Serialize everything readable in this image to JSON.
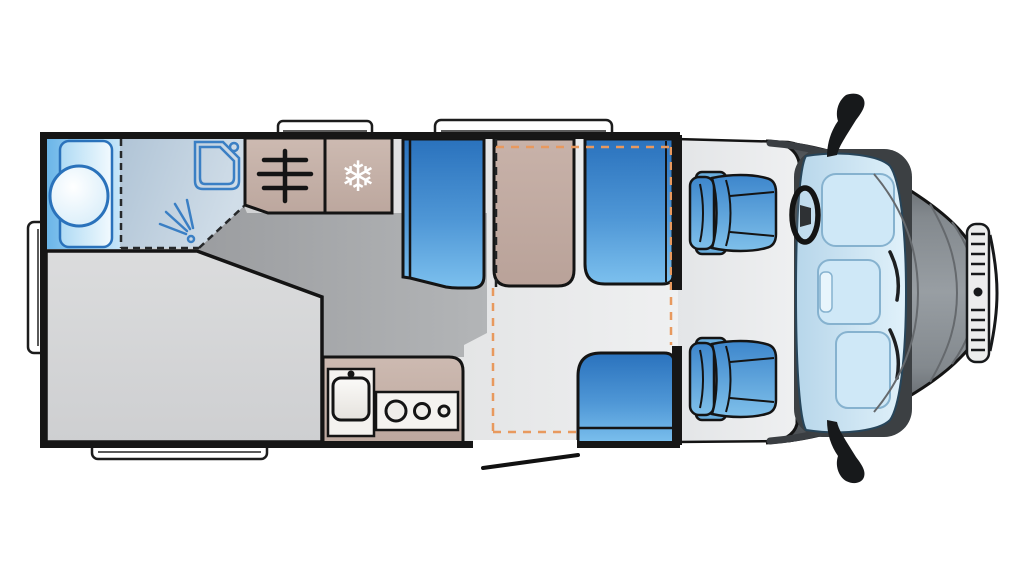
{
  "meta": {
    "title": "Motorhome floor plan, top view",
    "type": "vehicle-floorplan",
    "text_visible": false
  },
  "icons": {
    "snowflake_glyph": "❄",
    "names": [
      "roof-vent-icon",
      "side-hatch-icon",
      "wardrobe-rail-icon",
      "fridge-snowflake-icon",
      "shower-tray-icon",
      "shower-spray-icon",
      "washbasin-icon",
      "sink-icon",
      "hob-burners-icon",
      "steering-wheel-icon",
      "wing-mirror-icon",
      "grille-icon",
      "entrance-door-swing-icon",
      "drop-down-bed-outline"
    ]
  },
  "palette": {
    "background": "#ffffff",
    "wall": "#161616",
    "outline": "#141414",
    "furniture_beige": "#c6b2a9",
    "table_beige": "#bfa89f",
    "seat_blue_dark": "#2a72bd",
    "seat_blue_light": "#7cc0ee",
    "cab_seat_blue": "#3d86cc",
    "bathroom_blue": "#a8d8f4",
    "shower_gray_blue": "#bccfdd",
    "fixture_blue_line": "#3a7fc4",
    "floor_light": "#e9eaeb",
    "floor_mid": "#bfc1c3",
    "floor_dark": "#a5a7a9",
    "bed_gray": "#d6d7d9",
    "cab_body_gray": "#8f959a",
    "cab_body_shadow": "#3f4347",
    "windscreen_blue": "#cfe4f2",
    "dashed_bed_orange": "#e8995e",
    "dashed_partition_black": "#26282a"
  },
  "areas": {
    "bathroom": "rear washroom with basin, vanity and fold-away shower",
    "wardrobe": "wardrobe with clothes rail",
    "fridge": "refrigerator",
    "rear_bed": "rear french bed",
    "kitchen": "kitchen block with sink and 3-burner hob",
    "dinette": "dinette: two bench seats with table",
    "side_seat": "side bench seat at entrance door",
    "drop_down_bed": "drop-down bed outline (dashed)",
    "entrance_door": "entrance door opening with swing line",
    "cab": "driver cab with two swivel seats, steering wheel and windscreen"
  }
}
